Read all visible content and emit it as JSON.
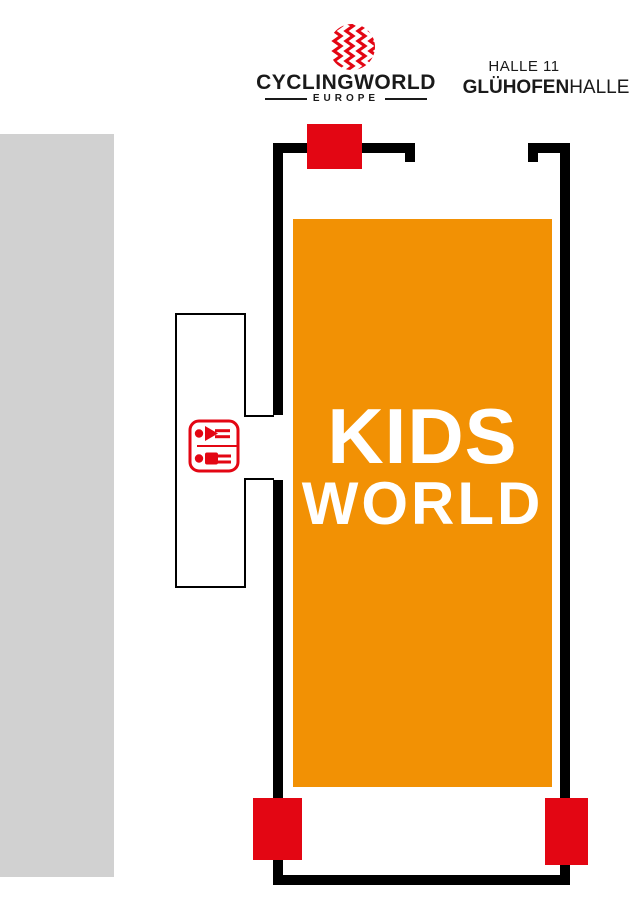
{
  "page": {
    "width_px": 640,
    "height_px": 914,
    "background": "#FFFFFF"
  },
  "header": {
    "brand": {
      "name": "CYCLINGWORLD",
      "region": "EUROPE",
      "logo_color": "#E30613",
      "text_color": "#1A1A1A"
    },
    "hall": {
      "line1": "HALLE 11",
      "line2_bold": "GLÜHOFEN",
      "line2_regular": "HALLE"
    }
  },
  "floorplan": {
    "area": {
      "label_line1": "KIDS",
      "label_line2": "WORLD",
      "fill": "#F29104",
      "text_color": "#FFFFFF"
    },
    "walls": {
      "color": "#000000"
    },
    "adjacent_hall": {
      "fill": "#D1D1D1"
    },
    "entrances": {
      "color": "#E30613",
      "positions": [
        "top",
        "bottom-left",
        "bottom-right"
      ]
    },
    "restroom": {
      "icon": "wc-restroom-icon",
      "color": "#E30613"
    }
  }
}
